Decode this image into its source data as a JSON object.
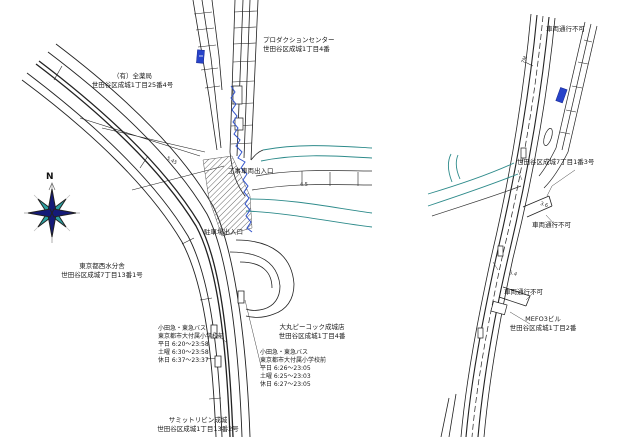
{
  "colors": {
    "line": "#222222",
    "teal_road": "#2e8b8b",
    "boundary_blue": "#3355cc",
    "route_sign_blue": "#2743c9",
    "compass_navy": "#141a78",
    "compass_teal": "#2ba0a0",
    "hatch": "#666666"
  },
  "left_map": {
    "compass_label": "N",
    "labels": {
      "production_center": {
        "name": "プロダクションセンター",
        "address": "世田谷区成城1丁目4番"
      },
      "pharmacy": {
        "name": "（有）全薬局",
        "address": "世田谷区成城1丁目25番4号"
      },
      "construction_entrance": "工事車両出入口",
      "parking_entrance": "駐車場出入口",
      "water_office": {
        "name": "東京都西水分舎",
        "address": "世田谷区成城7丁目13番1号"
      },
      "bus_stop_west": {
        "operator": "小田急・東急バス",
        "stop_name": "東京都市大付属小学校前",
        "weekday": "平日 6:20〜23:58",
        "saturday": "土曜 6:30〜23:58",
        "holiday": "休日 6:37〜23:37"
      },
      "supermarket": {
        "name": "大丸ピーコック成城店",
        "address": "世田谷区成城1丁目4番"
      },
      "bus_stop_east": {
        "operator": "小田急・東急バス",
        "stop_name": "東京都市大付属小学校前",
        "weekday": "平日 6:26〜23:05",
        "saturday": "土曜 6:25〜23:03",
        "holiday": "休日 6:27〜23:05"
      },
      "summit_store": {
        "name": "サミットリビン成城",
        "address": "世田谷区成城1丁目13番2号"
      }
    }
  },
  "right_map": {
    "labels": {
      "no_vehicles_top": "車両通行不可",
      "address_7_1_3": "世田谷区成城7丁目1番3号",
      "no_vehicles_mid": "車両通行不可",
      "no_vehicles_low": "車両通行不可",
      "mefo_building": {
        "name": "MEFO3ビル",
        "address": "世田谷区成城1丁目2番"
      }
    }
  },
  "dimensions": {
    "d1": "7M",
    "d2": "3.6",
    "d3": "5.4",
    "d4": "4.5",
    "d5": "5.45"
  }
}
